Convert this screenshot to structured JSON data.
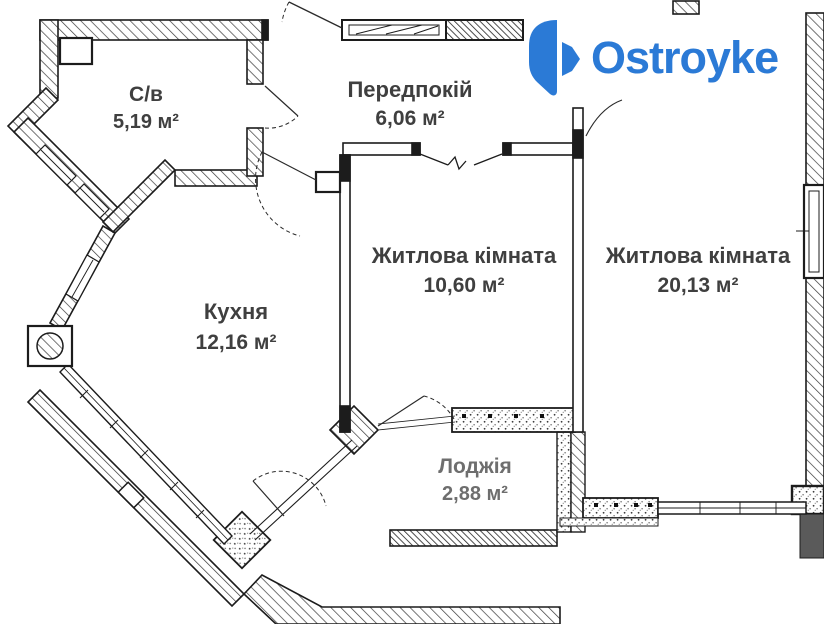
{
  "logo": {
    "brand": "Ostroyke",
    "color": "#2b7ad6",
    "icon": "ostroyke-house-pin-icon"
  },
  "floorplan": {
    "rooms": [
      {
        "id": "bathroom",
        "name": "С/в",
        "area": "5,19 м²"
      },
      {
        "id": "hallway",
        "name": "Передпокій",
        "area": "6,06 м²"
      },
      {
        "id": "kitchen",
        "name": "Кухня",
        "area": "12,16 м²"
      },
      {
        "id": "living1",
        "name": "Житлова кімната",
        "area": "10,60 м²"
      },
      {
        "id": "living2",
        "name": "Житлова кімната",
        "area": "20,13 м²"
      },
      {
        "id": "loggia",
        "name": "Лоджія",
        "area": "2,88 м²"
      }
    ],
    "colors": {
      "wall": "#1c1c1c",
      "hatch": "#3a3a3a",
      "label": "#3f3f3f",
      "loggia_label": "#6e6e6e",
      "background": "#ffffff"
    }
  }
}
